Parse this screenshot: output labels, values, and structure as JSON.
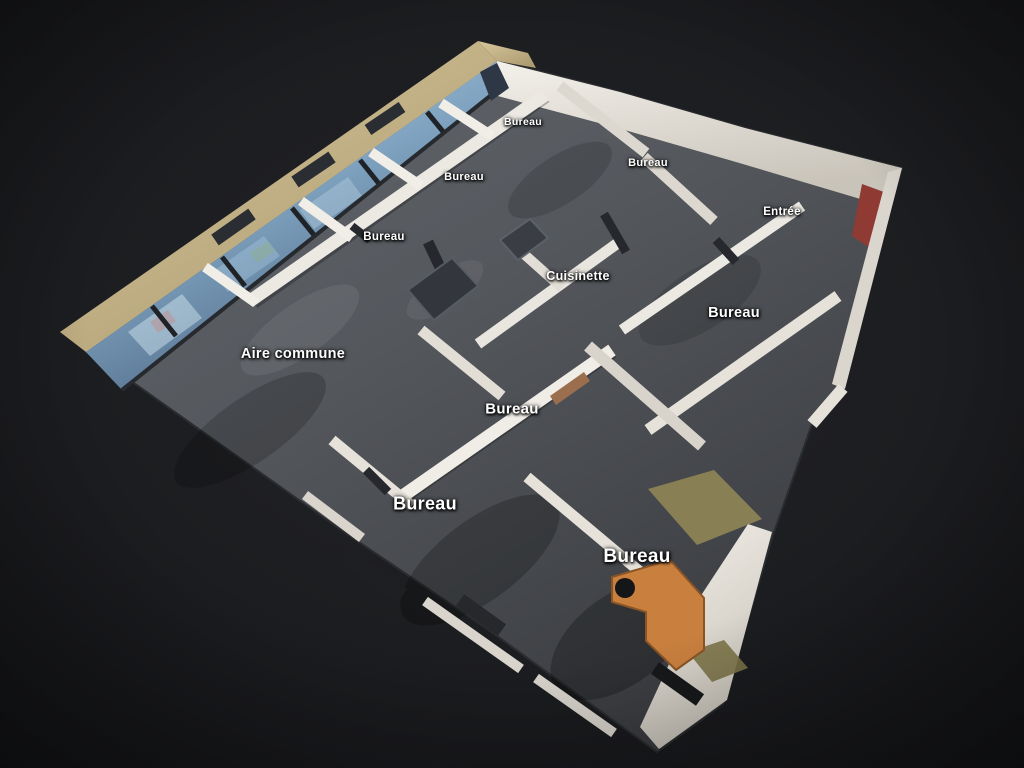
{
  "viewer": {
    "view_name": "dollhouse-floorplan-3d",
    "labels": [
      {
        "text": "Bureau",
        "x": 523,
        "y": 122,
        "size": 10.5
      },
      {
        "text": "Bureau",
        "x": 648,
        "y": 163,
        "size": 11
      },
      {
        "text": "Bureau",
        "x": 464,
        "y": 177,
        "size": 11
      },
      {
        "text": "Entrée",
        "x": 782,
        "y": 212,
        "size": 11.5
      },
      {
        "text": "Bureau",
        "x": 384,
        "y": 237,
        "size": 11.5
      },
      {
        "text": "Cuisinette",
        "x": 578,
        "y": 276,
        "size": 12.5
      },
      {
        "text": "Bureau",
        "x": 734,
        "y": 313,
        "size": 14.5
      },
      {
        "text": "Aire commune",
        "x": 293,
        "y": 354,
        "size": 14.5
      },
      {
        "text": "Bureau",
        "x": 512,
        "y": 409,
        "size": 15
      },
      {
        "text": "Bureau",
        "x": 425,
        "y": 504,
        "size": 18
      },
      {
        "text": "Bureau",
        "x": 637,
        "y": 557,
        "size": 19
      }
    ],
    "colors": {
      "background": "#1b1c1f",
      "carpet": "#55585e",
      "wall": "#eceae4",
      "window_sill_beige": "#c9b88e",
      "window_glass": "#8fb4cc",
      "desk_orange": "#c9803f",
      "accent_red": "#8f3a33",
      "rug_khaki": "#8e8456",
      "label_text": "#ffffff"
    }
  }
}
